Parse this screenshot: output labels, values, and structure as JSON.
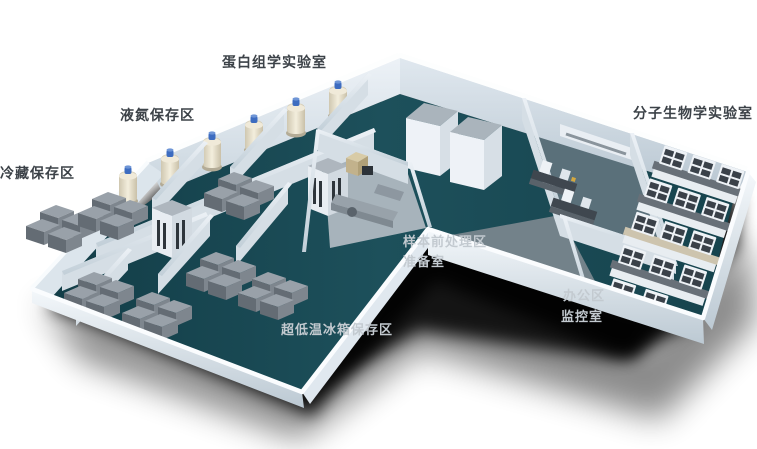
{
  "labels": {
    "proteomics_lab": "蛋白组学实验室",
    "liquid_nitrogen_storage": "液氮保存区",
    "cold_storage": "冷藏保存区",
    "molecular_biology_lab": "分子生物学实验室",
    "sample_pretreatment": "样本前处理区",
    "preparation_room": "准备室",
    "office_area": "办公区",
    "monitoring_room": "监控室",
    "ult_freezer_storage": "超低温冰箱保存区"
  },
  "colors": {
    "background": "#ffffff",
    "label_dark": "#3c4248",
    "label_light": "#c3cad0",
    "floor_teal": "#1a4a53",
    "wall_light": "#eef3f8",
    "wall_shade": "#c7d3dc",
    "tank_body": "#ece5d2",
    "tank_cap": "#3d6cc0",
    "freezer_gray": "#7a828a",
    "bench_top": "#687078",
    "shadow": "#000000"
  }
}
